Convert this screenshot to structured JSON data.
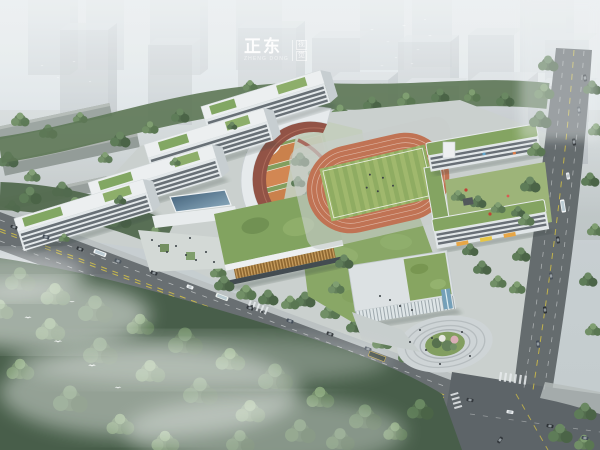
{
  "scene": {
    "type": "aerial-architectural-rendering",
    "subject": "school campus with oval running track, white classroom slabs, curved link building, green roofs, city blocks in haze, roads with traffic and forest below"
  },
  "watermark": {
    "brand": "正东",
    "subtitle": "ZHENG DONG",
    "side_top": "视",
    "side_bottom": "觉"
  },
  "palette": {
    "haze_white": "#eef1f3",
    "city_block_front": "#a9b0b4",
    "city_block_top": "#cdd2d5",
    "building_white": "#e8ebec",
    "roof_green": "#7da35b",
    "track_orange": "#bf6c4b",
    "field_green_light": "#9db565",
    "field_green_dark": "#8ba85a",
    "court_orange": "#c97b42",
    "terrace_red": "#8e4a3c",
    "wood_slat_brown": "#a5783a",
    "asphalt_gray": "#5e6467",
    "tree_dark_green": "#44593f",
    "tree_mid_green": "#5d7a52",
    "water_blue": "#6e9cb6",
    "awning_orange": "#e8a23c",
    "lane_yellow": "#d8c23a"
  }
}
